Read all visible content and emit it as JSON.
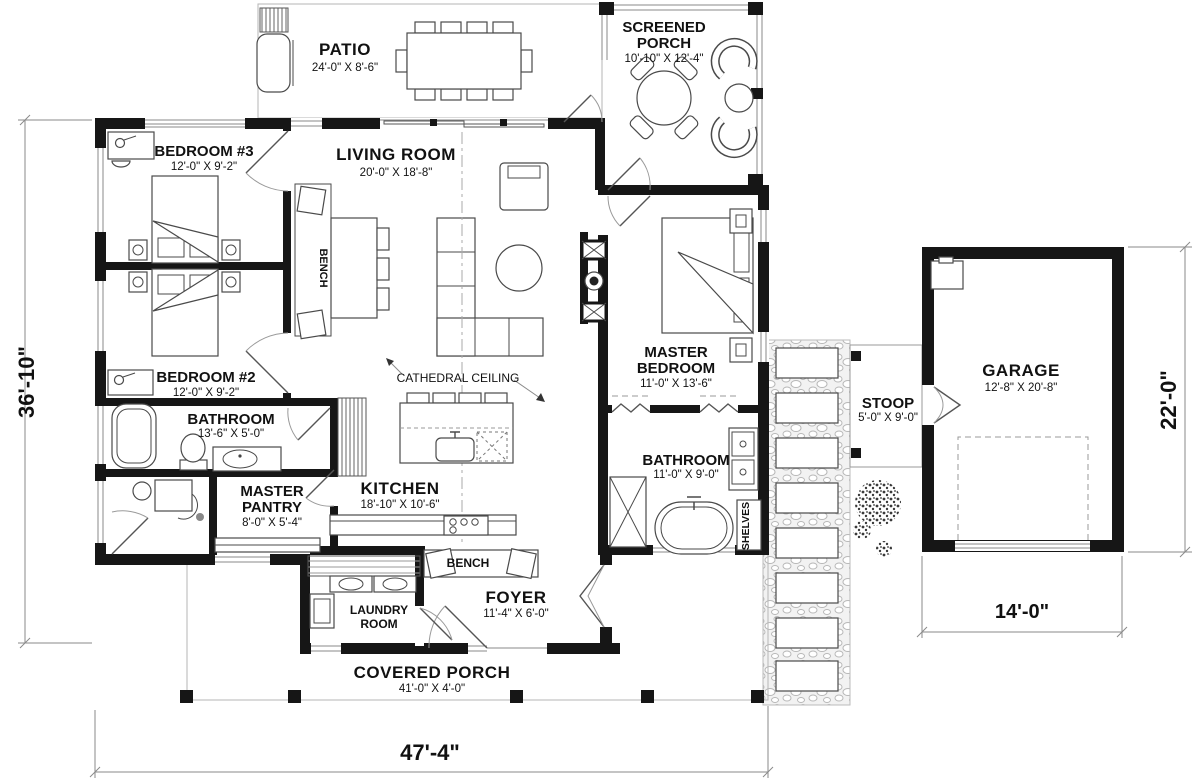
{
  "rooms": {
    "patio": {
      "label": "PATIO",
      "dims": "24'-0\" X 8'-6\""
    },
    "screened_porch": {
      "line1": "SCREENED",
      "line2": "PORCH",
      "dims": "10'-10\" X 12'-4\""
    },
    "bedroom3": {
      "label": "BEDROOM #3",
      "dims": "12'-0\" X 9'-2\""
    },
    "living_room": {
      "label": "LIVING ROOM",
      "dims": "20'-0\" X 18'-8\""
    },
    "master_bedroom": {
      "line1": "MASTER",
      "line2": "BEDROOM",
      "dims": "11'-0\" X 13'-6\""
    },
    "bedroom2": {
      "label": "BEDROOM #2",
      "dims": "12'-0\" X 9'-2\""
    },
    "bathroom": {
      "label": "BATHROOM",
      "dims": "13'-6\" X 5'-0\""
    },
    "master_pantry": {
      "line1": "MASTER",
      "line2": "PANTRY",
      "dims": "8'-0\" X 5'-4\""
    },
    "kitchen": {
      "label": "KITCHEN",
      "dims": "18'-10\" X 10'-6\""
    },
    "master_bathroom": {
      "label": "BATHROOM",
      "dims": "11'-0\" X 9'-0\""
    },
    "laundry": {
      "line1": "LAUNDRY",
      "line2": "ROOM"
    },
    "foyer": {
      "label": "FOYER",
      "dims": "11'-4\" X 6'-0\""
    },
    "garage": {
      "label": "GARAGE",
      "dims": "12'-8\" X 20'-8\""
    },
    "stoop": {
      "label": "STOOP",
      "dims": "5'-0\" X 9'-0\""
    },
    "covered_porch": {
      "label": "COVERED PORCH",
      "dims": "41'-0\" X 4'-0\""
    }
  },
  "annotations": {
    "cathedral_ceiling": "CATHEDRAL CEILING",
    "bench_living": "BENCH",
    "bench_foyer": "BENCH",
    "shelves": "SHELVES"
  },
  "dimensions": {
    "overall_width": "47'-4\"",
    "overall_depth": "36'-10\"",
    "garage_depth": "22'-0\"",
    "garage_width": "14'-0\""
  },
  "colors": {
    "wall": "#161616",
    "line_gray": "#8a8a8a",
    "text": "#111111",
    "background": "#ffffff"
  }
}
